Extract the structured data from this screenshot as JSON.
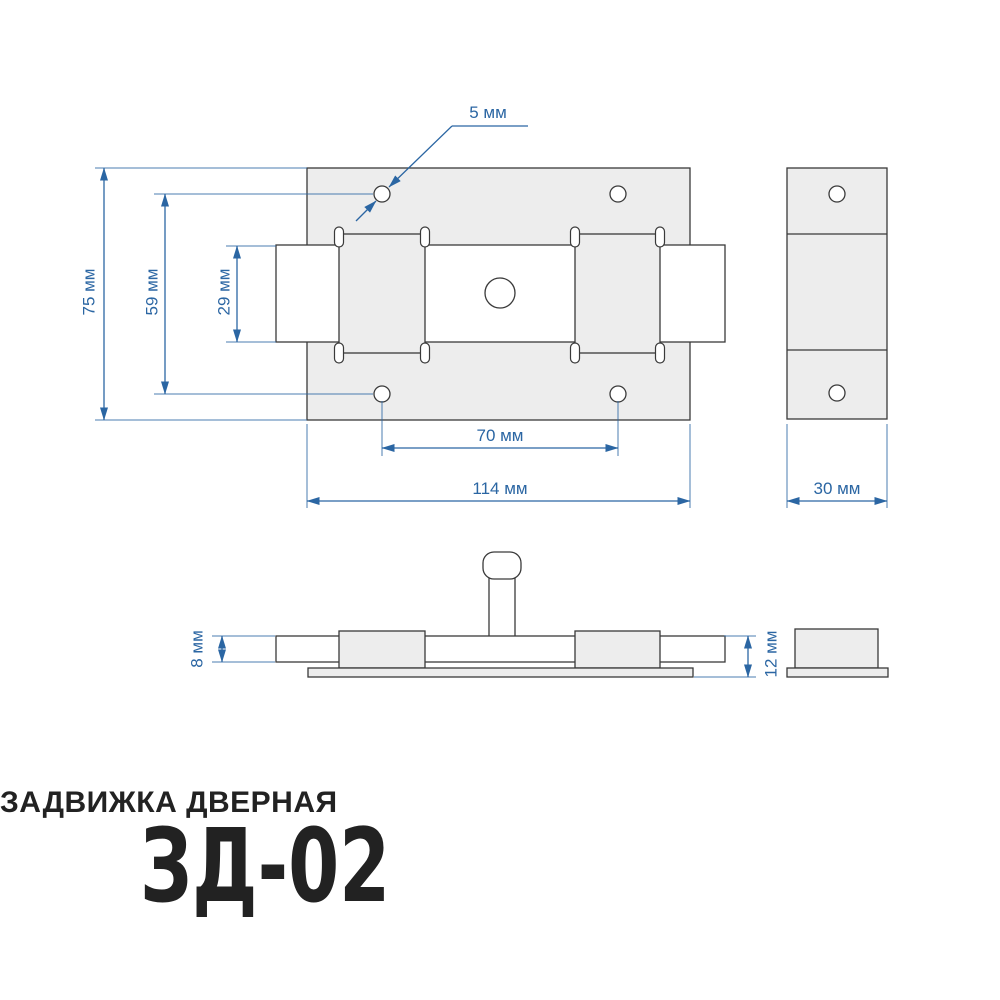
{
  "product": {
    "title": "ЗАДВИЖКА ДВЕРНАЯ",
    "model": "ЗД-02"
  },
  "dimensions": {
    "hole_diameter": "5 мм",
    "plate_height": "75 мм",
    "hole_spacing_vertical": "59 мм",
    "bolt_width": "29 мм",
    "hole_spacing_horizontal": "70 мм",
    "plate_width": "114 мм",
    "keeper_width": "30 мм",
    "bolt_thickness": "8 мм",
    "overall_thickness": "12 мм"
  },
  "colors": {
    "dimension_blue": "#2b66a3",
    "outline_dark": "#3a3a3a",
    "metal_fill": "#ededed",
    "title_black": "#222222",
    "background": "#ffffff"
  }
}
